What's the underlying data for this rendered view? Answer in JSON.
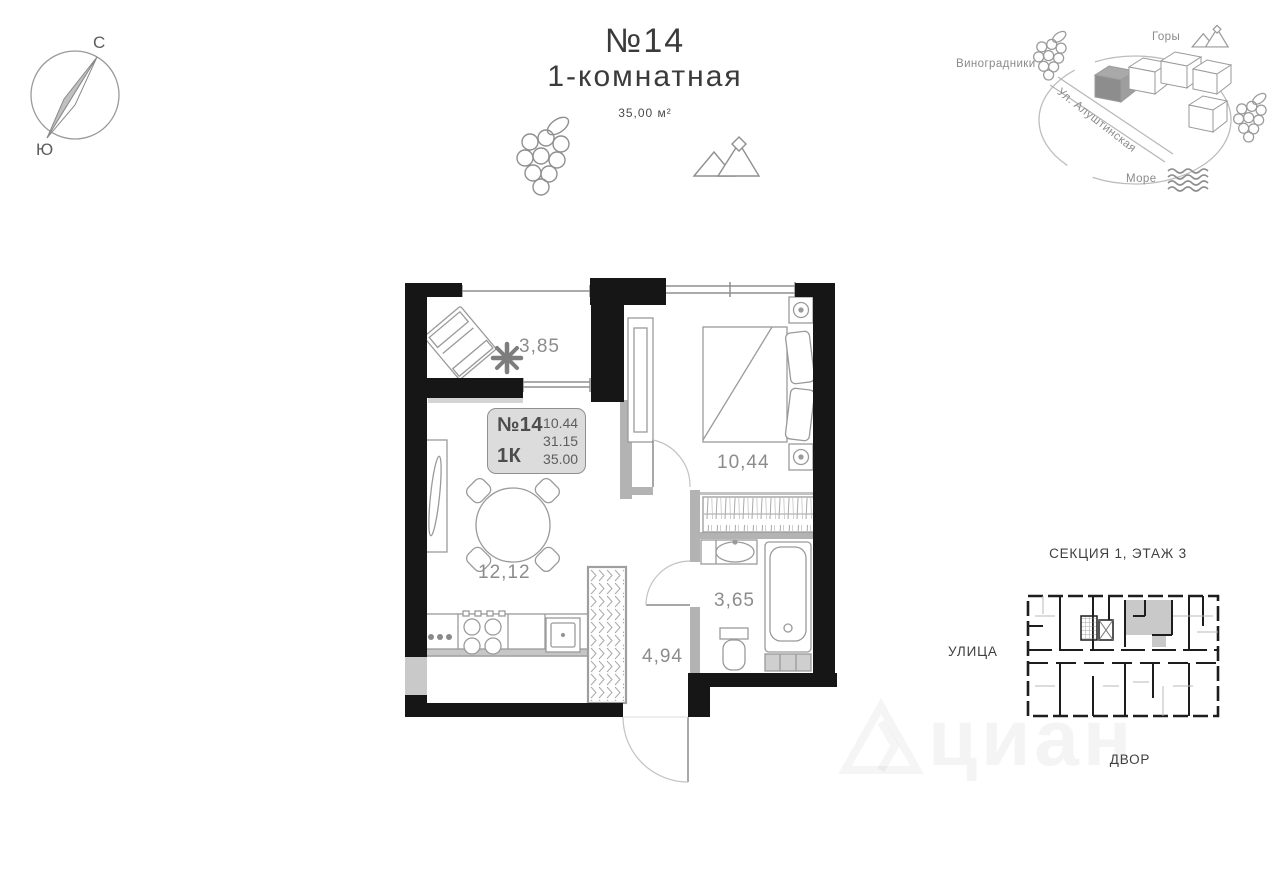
{
  "compass": {
    "north": "С",
    "south": "Ю"
  },
  "header": {
    "number": "№14",
    "type": "1-комнатная",
    "area": "35,00 м²"
  },
  "locator": {
    "vineyards": "Виноградники",
    "mountains": "Горы",
    "street": "Ул. Алуштинская",
    "sea": "Море"
  },
  "plan": {
    "info_box": {
      "number": "№14",
      "rooms": "1К",
      "line1": "10.44",
      "line2": "31.15",
      "line3": "35.00"
    },
    "rooms": {
      "balcony": "3,85",
      "bedroom": "10,44",
      "living": "12,12",
      "bathroom": "3,65",
      "hall": "4,94"
    }
  },
  "key_plan": {
    "title": "СЕКЦИЯ 1, ЭТАЖ 3",
    "street": "УЛИЦА",
    "yard": "ДВОР"
  },
  "watermark": {
    "text": "циан"
  },
  "colors": {
    "wall": "#161616",
    "partition": "#b3b3b3",
    "furniture_line": "#9a9a9a",
    "label_text": "#8c8c8c",
    "infobox_bg": "#dcdcdc",
    "key_highlight": "#c9c9c9"
  }
}
